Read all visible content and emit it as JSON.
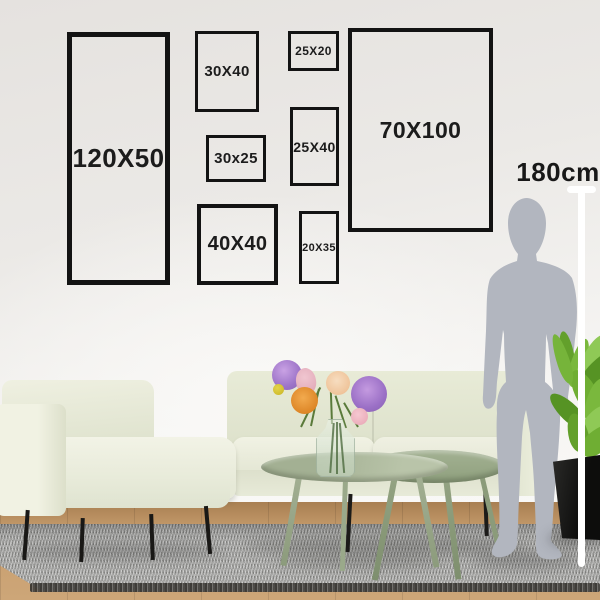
{
  "frames": [
    {
      "label": "120X50"
    },
    {
      "label": "30X40"
    },
    {
      "label": "25X20"
    },
    {
      "label": "30x25"
    },
    {
      "label": "25X40"
    },
    {
      "label": "40X40"
    },
    {
      "label": "20X35"
    },
    {
      "label": "70X100"
    }
  ],
  "scale": {
    "height_label": "180cm"
  },
  "scene_objects": [
    "gallery-wall-frames",
    "person-silhouette",
    "height-measuring-line",
    "sofa",
    "armchair",
    "coffee-tables",
    "flower-vase",
    "potted-plant",
    "rug",
    "wood-floor"
  ],
  "colors": {
    "frame_border": "#131313",
    "frame_text": "#1c1c1c",
    "wall": "#e8e6e3",
    "sofa_fabric": "#e9ebd9",
    "table_sage": "#a9b69a",
    "rug_gray": "#a9a9a7",
    "wood_floor": "#c89e6e",
    "silhouette_gray": "#b2b6bf",
    "measure_line": "#ffffff",
    "plant_green": "#6fae33",
    "flower_purple": "#9d74c8",
    "flower_orange": "#dd8627",
    "flower_pink": "#e8b4c0",
    "flower_yellow": "#d4c23a",
    "pot_black": "#161614"
  }
}
